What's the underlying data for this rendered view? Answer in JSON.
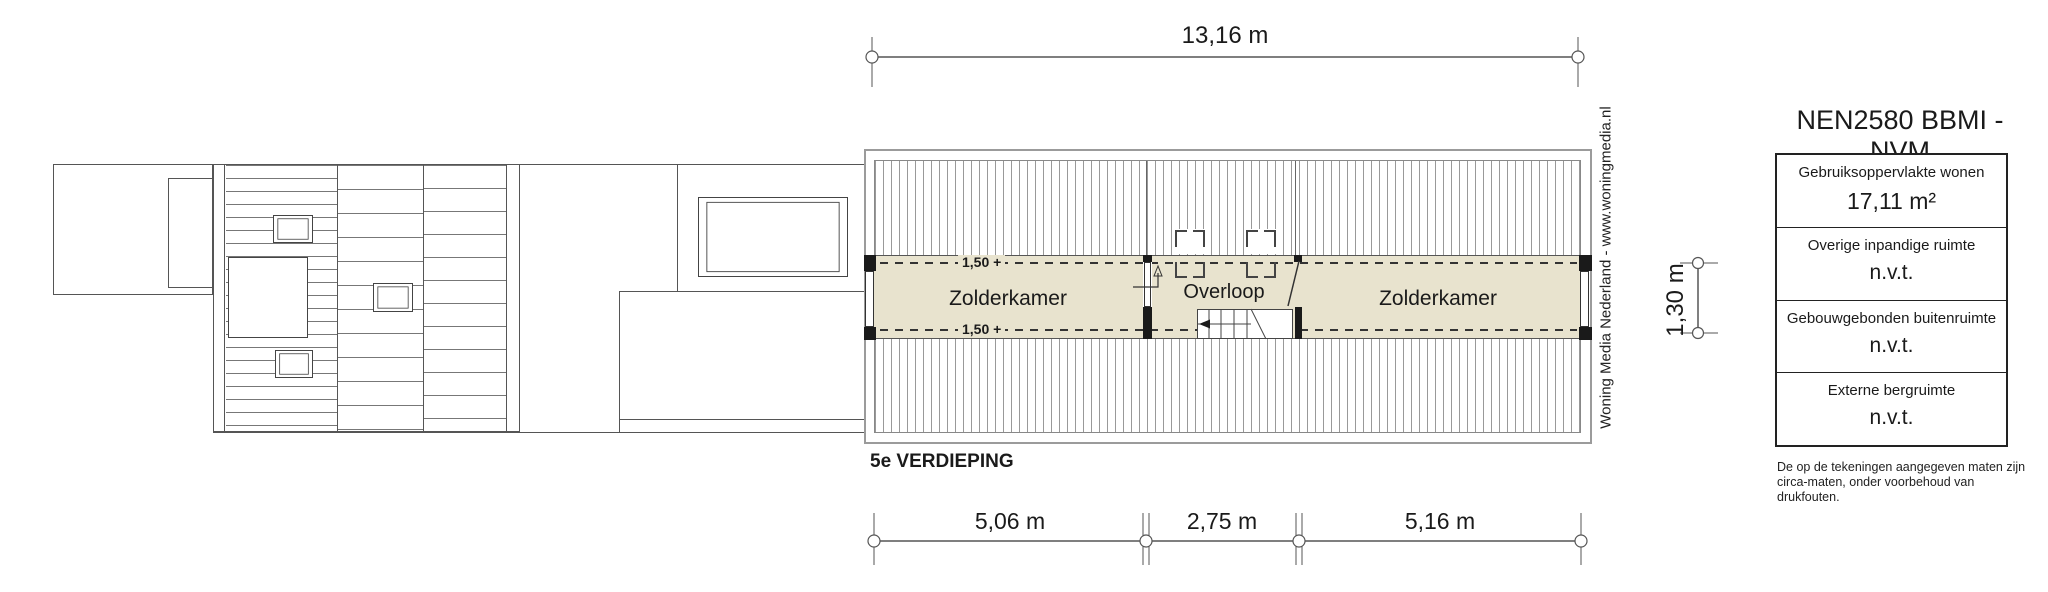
{
  "plan": {
    "floor_label": "5e VERDIEPING",
    "rooms": {
      "zolderkamer_left": "Zolderkamer",
      "overloop": "Overloop",
      "zolderkamer_right": "Zolderkamer"
    },
    "level_marks": {
      "top": "1,50 +",
      "bottom": "1,50 +"
    }
  },
  "dimensions": {
    "top_width": "13,16 m",
    "bottom_segments": [
      "5,06 m",
      "2,75 m",
      "5,16 m"
    ],
    "right_height": "1,30 m"
  },
  "watermark": "Woning Media Nederland - www.woningmedia.nl",
  "legend": {
    "title": "NEN2580 BBMI - NVM",
    "rows": [
      {
        "label": "Gebruiksoppervlakte wonen",
        "value": "17,11 m²"
      },
      {
        "label": "Overige inpandige ruimte",
        "value": "n.v.t."
      },
      {
        "label": "Gebouwgebonden buitenruimte",
        "value": "n.v.t."
      },
      {
        "label": "Externe bergruimte",
        "value": "n.v.t."
      }
    ],
    "footnote_line1": "De op de tekeningen aangegeven maten zijn",
    "footnote_line2": "circa-maten, onder voorbehoud van drukfouten."
  },
  "colors": {
    "room_fill": "#e8e3ce",
    "wall": "#1a1a1a",
    "line": "#555555",
    "hatch": "#8a8a8a",
    "frame": "#9b9b9b"
  }
}
